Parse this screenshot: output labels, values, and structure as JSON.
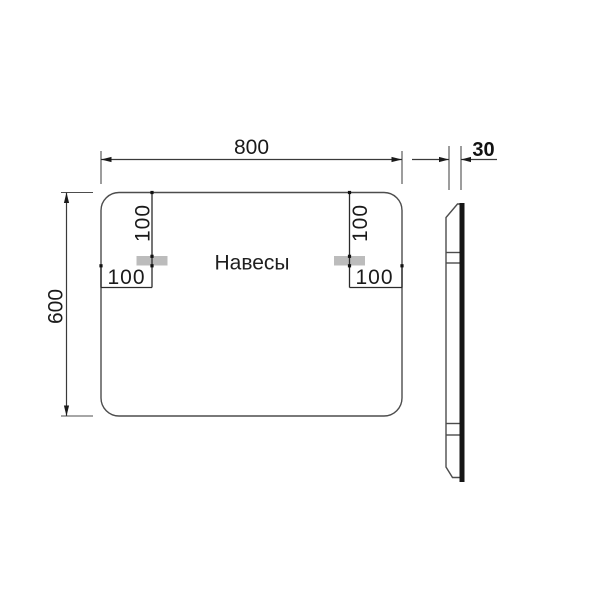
{
  "drawing_type": "mirror-dimension-drawing",
  "colors": {
    "line": "#4d4d4d",
    "text": "#1a1a1a",
    "hanger_plate_fill": "#bcbcbc",
    "glass_edge_fill": "#161616",
    "background": "#ffffff"
  },
  "front_view": {
    "width_dim": "800",
    "height_dim": "600",
    "hangers_label": "Навесы",
    "left_hanger": {
      "top_offset_dim": "100",
      "side_offset_dim": "100"
    },
    "right_hanger": {
      "top_offset_dim": "100",
      "side_offset_dim": "100"
    }
  },
  "side_view": {
    "depth_dim": "30"
  }
}
